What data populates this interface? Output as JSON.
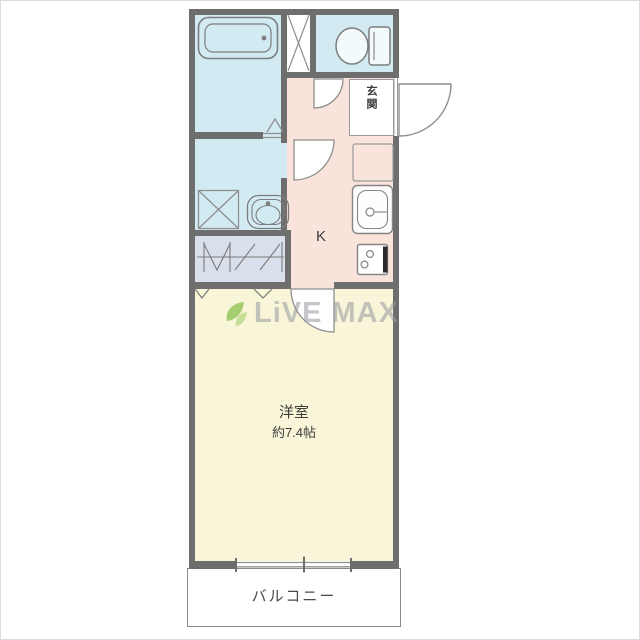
{
  "plan": {
    "type": "floorplan",
    "labels": {
      "entrance": "玄関",
      "kitchen": "K",
      "room_name": "洋室",
      "room_size": "約7.4帖",
      "balcony": "バルコニー"
    },
    "watermark": {
      "brand": "LiVE MAX",
      "icon": "leaf-icon"
    },
    "colors": {
      "wall": "#6e6e6e",
      "wet_area_floor": "#d2ebf2",
      "kitchen_floor": "#f9e3da",
      "room_floor": "#f8f5d9",
      "closet_floor": "#dae0eb",
      "entrance_floor": "#ffffff",
      "balcony_floor": "#ffffff",
      "stove_accent": "#2c2c2c",
      "watermark_text": "#94989c",
      "watermark_leaf": "#8cbf4d"
    },
    "fixtures": [
      "bathtub-icon",
      "toilet-icon",
      "pipe-space-x-icon",
      "washing-machine-pan-icon",
      "vanity-sink-icon",
      "kitchen-counter",
      "kitchen-sink-icon",
      "stove-icon",
      "closet-bifold-door-icon",
      "entrance-door-arc-icon",
      "toilet-door-arc-icon",
      "washroom-door-arc-icon",
      "room-door-arc-icon",
      "bath-folding-door-icon",
      "sliding-window-icon"
    ]
  }
}
